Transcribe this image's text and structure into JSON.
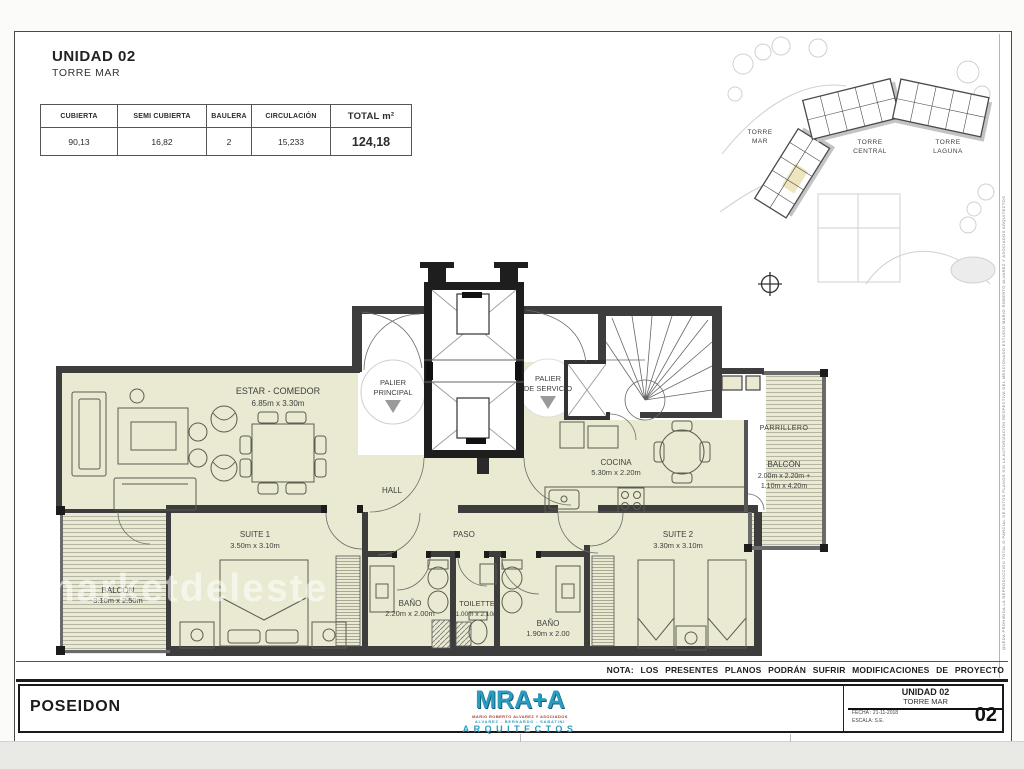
{
  "header": {
    "title": "UNIDAD 02",
    "subtitle": "TORRE MAR"
  },
  "areas_table": {
    "columns": [
      {
        "header": "CUBIERTA",
        "value": "90,13"
      },
      {
        "header": "SEMI CUBIERTA",
        "value": "16,82"
      },
      {
        "header": "BAULERA",
        "value": "2"
      },
      {
        "header": "CIRCULACIÓN",
        "value": "15,233"
      },
      {
        "header": "TOTAL m²",
        "value": "124,18"
      }
    ]
  },
  "site_plan": {
    "towers": [
      {
        "line1": "TORRE",
        "line2": "MAR"
      },
      {
        "line1": "TORRE",
        "line2": "CENTRAL"
      },
      {
        "line1": "TORRE",
        "line2": "LAGUNA"
      }
    ]
  },
  "plan": {
    "rooms": {
      "estar": {
        "name": "ESTAR - COMEDOR",
        "dims": "6.85m x 3.30m"
      },
      "palier_principal": {
        "line1": "PALIER",
        "line2": "PRINCIPAL"
      },
      "palier_servicio": {
        "line1": "PALIER",
        "line2": "DE SERVICIO"
      },
      "hall": {
        "name": "HALL"
      },
      "paso": {
        "name": "PASO"
      },
      "cocina": {
        "name": "COCINA",
        "dims": "5.30m x 2.20m"
      },
      "parrillero": {
        "name": "PARRILLERO"
      },
      "balcon_este": {
        "name": "BALCÓN",
        "dims1": "2.00m x 2.20m +",
        "dims2": "1.10m x 4.20m"
      },
      "suite1": {
        "name": "SUITE 1",
        "dims": "3.50m x 3.10m"
      },
      "suite2": {
        "name": "SUITE 2",
        "dims": "3.30m x 3.10m"
      },
      "bano1": {
        "name": "BAÑO",
        "dims": "2.20m x 2.00m"
      },
      "toilette": {
        "name": "TOILETTE",
        "dims": "1.00m x 2.10m"
      },
      "bano2": {
        "name": "BAÑO",
        "dims": "1.90m x 2.00"
      },
      "balcon_oeste": {
        "name": "BALCÓN",
        "dims": "3.10m x 2.50m"
      }
    },
    "nota": "NOTA: LOS PRESENTES PLANOS PODRÁN SUFRIR MODIFICACIONES DE PROYECTO"
  },
  "watermark": "marketdeleste",
  "side_note": "QUEDA PROHIBIDA LA REPRODUCCIÓN TOTAL O PARCIAL DE ESTOS PLANOS SIN LA AUTORIZACIÓN RESPECTIVA DEL MENCIONADO ESTUDIO MARIO ROBERTO ALVAREZ Y ASOCIADOS ARQUITECTOS",
  "footer": {
    "project": "POSEIDON",
    "logo": {
      "brand": "MRA+A",
      "sub1": "MARIO ROBERTO ALVAREZ Y ASOCIADOS",
      "sub2": "ALVAREZ - BERNARDO - SABATINI",
      "sub3": "ARQUITECTOS"
    },
    "title_block": {
      "unit": "UNIDAD 02",
      "tower": "TORRE MAR",
      "fecha": "FECHA : 21-11-2018",
      "escala": "ESCALA: S.E.",
      "sheet_number": "02"
    }
  },
  "colors": {
    "cream": "#e9ead1",
    "wall": "#3d3d3d",
    "logo_teal": "#2a9cbd",
    "logo_red": "#b23a2c"
  }
}
